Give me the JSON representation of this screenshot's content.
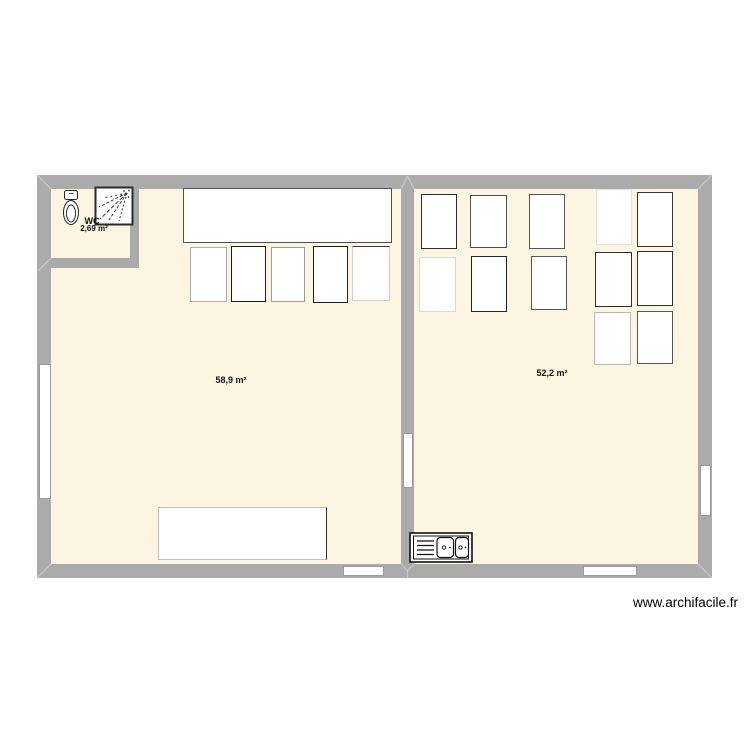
{
  "watermark": "www.archifacile.fr",
  "rooms": {
    "wc": {
      "label": "WC",
      "area": "2,69 m²"
    },
    "left": {
      "area": "58,9 m²"
    },
    "right": {
      "area": "52,2 m²"
    }
  },
  "icons": [
    "toilet-icon",
    "shower-icon",
    "sink-icon"
  ],
  "colors": {
    "wall": "#ababab",
    "floor": "#fbf5e1",
    "furniture_fill": "#ffffff",
    "opening_border": "#9b9b9b",
    "miter": "#c9c9c9",
    "text": "#111111"
  },
  "plan": {
    "floors": [
      {
        "name": "floor-left-room",
        "x": 51,
        "y": 189,
        "w": 350,
        "h": 375
      },
      {
        "name": "floor-right-room",
        "x": 414,
        "y": 189,
        "w": 284,
        "h": 375
      }
    ],
    "walls": [
      {
        "name": "wall-top",
        "x": 37,
        "y": 175,
        "w": 675,
        "h": 14
      },
      {
        "name": "wall-bottom",
        "x": 37,
        "y": 564,
        "w": 675,
        "h": 14
      },
      {
        "name": "wall-left",
        "x": 37,
        "y": 175,
        "w": 14,
        "h": 403
      },
      {
        "name": "wall-right",
        "x": 698,
        "y": 175,
        "w": 14,
        "h": 403
      },
      {
        "name": "wall-divider",
        "x": 401,
        "y": 189,
        "w": 13,
        "h": 375
      },
      {
        "name": "wall-wc-right",
        "x": 130,
        "y": 189,
        "w": 9,
        "h": 79
      },
      {
        "name": "wall-wc-bottom",
        "x": 37,
        "y": 258,
        "w": 102,
        "h": 10
      }
    ],
    "openings": [
      {
        "name": "window-left-wall",
        "x": 39,
        "y": 364,
        "w": 12,
        "h": 135
      },
      {
        "name": "window-bottom-left",
        "x": 343,
        "y": 566,
        "w": 41,
        "h": 10
      },
      {
        "name": "window-bottom-right",
        "x": 583,
        "y": 566,
        "w": 54,
        "h": 10
      },
      {
        "name": "window-right-wall",
        "x": 700,
        "y": 465,
        "w": 11,
        "h": 51
      },
      {
        "name": "door-divider",
        "x": 403,
        "y": 433,
        "w": 10,
        "h": 55
      }
    ],
    "furniture": [
      {
        "name": "table-left-top",
        "x": 183,
        "y": 188,
        "w": 209,
        "h": 55,
        "b": "#4f4f4f"
      },
      {
        "name": "table-left-row-1",
        "x": 190,
        "y": 247,
        "w": 37,
        "h": 55,
        "b": "#adadad"
      },
      {
        "name": "table-left-row-2",
        "x": 231,
        "y": 246,
        "w": 35,
        "h": 56,
        "b": "#1e1e1e"
      },
      {
        "name": "table-left-row-3",
        "x": 271,
        "y": 247,
        "w": 34,
        "h": 55,
        "b": "#9c9c9c"
      },
      {
        "name": "table-left-row-4",
        "x": 313,
        "y": 246,
        "w": 35,
        "h": 57,
        "b": "#1e1e1e"
      },
      {
        "name": "table-left-row-5",
        "x": 352,
        "y": 246,
        "w": 38,
        "h": 55,
        "b": "#cfcfcf",
        "bt": "#3a3a3a"
      },
      {
        "name": "table-left-bottom",
        "x": 158,
        "y": 507,
        "w": 169,
        "h": 53,
        "b": "#bdbdbd",
        "br": "#2e2e2e"
      },
      {
        "name": "table-right-a1",
        "x": 421,
        "y": 194,
        "w": 36,
        "h": 55,
        "b": "#2e2e2e"
      },
      {
        "name": "table-right-a2",
        "x": 470,
        "y": 195,
        "w": 37,
        "h": 53,
        "b": "#4f4f4f"
      },
      {
        "name": "table-right-a3",
        "x": 529,
        "y": 194,
        "w": 36,
        "h": 55,
        "b": "#565656"
      },
      {
        "name": "table-right-a4",
        "x": 419,
        "y": 257,
        "w": 37,
        "h": 55,
        "b": "#d8d8d8"
      },
      {
        "name": "table-right-a5",
        "x": 471,
        "y": 256,
        "w": 36,
        "h": 56,
        "b": "#222222"
      },
      {
        "name": "table-right-a6",
        "x": 531,
        "y": 256,
        "w": 36,
        "h": 54,
        "b": "#565656"
      },
      {
        "name": "table-right-b1",
        "x": 596,
        "y": 189,
        "w": 36,
        "h": 56,
        "b": "#e2e2e2"
      },
      {
        "name": "table-right-b2",
        "x": 637,
        "y": 192,
        "w": 36,
        "h": 55,
        "b": "#343434"
      },
      {
        "name": "table-right-b3",
        "x": 595,
        "y": 252,
        "w": 37,
        "h": 55,
        "b": "#2e2e2e"
      },
      {
        "name": "table-right-b4",
        "x": 637,
        "y": 251,
        "w": 36,
        "h": 55,
        "b": "#2e2e2e"
      },
      {
        "name": "table-right-b5",
        "x": 594,
        "y": 312,
        "w": 37,
        "h": 53,
        "b": "#b7b7b7"
      },
      {
        "name": "table-right-b6",
        "x": 637,
        "y": 311,
        "w": 36,
        "h": 53,
        "b": "#565656"
      }
    ]
  }
}
